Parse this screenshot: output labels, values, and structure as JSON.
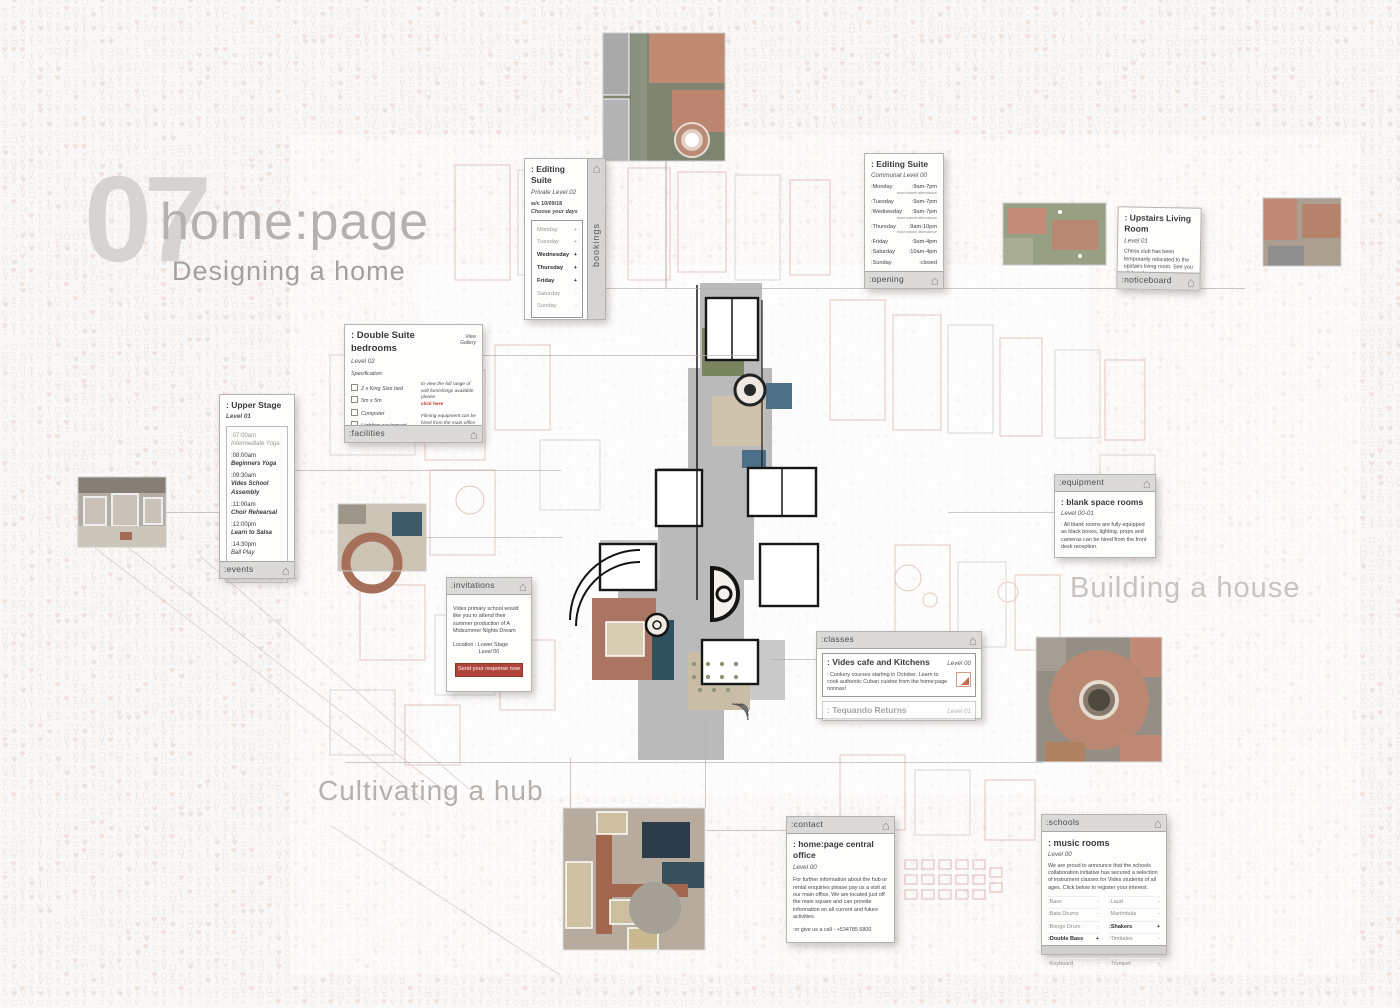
{
  "page": {
    "chapter_number": "07",
    "title": "home:page",
    "subtitle": "Designing a home",
    "section_building": "Building a house",
    "section_hub": "Cultivating a hub"
  },
  "colors": {
    "accent_red": "#b0463b",
    "link_red": "#c13a2b",
    "card_header_grey": "#dbdad8",
    "plan_brick": "#aa7663",
    "plan_blue": "#4d7088",
    "plan_green": "#78855f"
  },
  "icons": {
    "home": "⌂"
  },
  "cards": {
    "bookings": {
      "tab": "bookings",
      "title": ": Editing Suite",
      "level": "Private Level 02",
      "week": "w/c 10/09/18",
      "prompt": "Choose your days",
      "days": [
        {
          "label": "Monday",
          "mark": "+"
        },
        {
          "label": "Tuesday",
          "mark": "+"
        },
        {
          "label": "Wednesday",
          "mark": "+"
        },
        {
          "label": "Thursday",
          "mark": "+"
        },
        {
          "label": "Friday",
          "mark": "+"
        },
        {
          "label": "Saturday",
          "mark": "-"
        },
        {
          "label": "Sunday",
          "mark": "-"
        }
      ]
    },
    "opening": {
      "tab": ":opening",
      "title": ": Editing Suite",
      "level": "Communal Level 00",
      "hours": [
        {
          "day": ":Monday",
          "time": ":9am-7pm",
          "note": "must submit attendance"
        },
        {
          "day": ":Tuesday",
          "time": ":9am-7pm",
          "note": ""
        },
        {
          "day": ":Wednesday",
          "time": ":9am-7pm",
          "note": "must submit attendance"
        },
        {
          "day": ":Thursday",
          "time": ":9am-10pm",
          "note": "must submit attendance"
        },
        {
          "day": ":Friday",
          "time": ":9am-4pm",
          "note": ""
        },
        {
          "day": ":Saturday",
          "time": ":10am-4pm",
          "note": ""
        },
        {
          "day": ":Sunday",
          "time": ":closed",
          "note": ""
        }
      ]
    },
    "noticeboard": {
      "tab": ":noticeboard",
      "title": ": Upstairs Living Room",
      "level": "Level 01",
      "body": "Chess club has been temporarily relocated to the upstairs living room. See you all there!"
    },
    "facilities": {
      "tab": ":facilities",
      "title": ": Double Suite bedrooms",
      "gallery_link": "View Gallery",
      "level": "Level 02",
      "spec_heading": "Specification:",
      "spec_items": [
        "2 x King Size bed",
        "5m x 5m",
        "Computer",
        "Lighting equipment",
        "Blackout Shutters"
      ],
      "side_text": "to view the full range of soft furnishings available please",
      "side_link": "click here",
      "side_text2": "Filming equipment can be hired from the main office"
    },
    "events": {
      "tab": ":events",
      "title": ": Upper Stage",
      "level": "Level 01",
      "schedule": [
        {
          "time": ":07:00am",
          "name": "Intermediate Yoga"
        },
        {
          "time": ":08:00am",
          "name": "Beginners Yoga"
        },
        {
          "time": ":09:30am",
          "name": "Vides School Assembly"
        },
        {
          "time": ":11:00am",
          "name": "Choir Rehearsal"
        },
        {
          "time": ":12:00pm",
          "name": "Learn to Salsa"
        },
        {
          "time": ":14:30pm",
          "name": "Ball Play"
        },
        {
          "time": ":17:00pm",
          "name": "Drama Club"
        }
      ]
    },
    "equipment": {
      "tab": ":equipment",
      "title": ": blank space rooms",
      "level": "Level 00-01",
      "body": ": All blank rooms are fully equipped as black boxes, lighting, props and cameras can be hired from the front desk reception."
    },
    "invitations": {
      "tab": ":invitations",
      "body": "Vides primary school would like you to attend their summer production of A Midsummer Nights Dream",
      "location": "Location : Lower Stage",
      "location_level": "Level 00",
      "button": "Send your response now"
    },
    "classes": {
      "tab": ":classes",
      "items": [
        {
          "title": ": Vides cafe and Kitchens",
          "level": "Level 00",
          "desc": ": Cookery courses starting in October. Learn to cook authentic Cuban cuisine from the home:page nonnas!"
        },
        {
          "title": ": Tequando Returns",
          "level": "Level 01",
          "desc": ""
        }
      ]
    },
    "contact": {
      "tab": ":contact",
      "title": ": home:page central office",
      "level": "Level 00",
      "body": "For further information about the hub or rental enquiries please pay us a visit at our main office. We are located just off the main square and can provide information on all current and future activities.",
      "phone": ":or give us a call - +534785 6800"
    },
    "schools": {
      "tab": ":schools",
      "title": ": music rooms",
      "level": "Level 00",
      "body": "We are proud to announce that the schools collaboration initiative has secured a selection of instrument classes for Vides students of all ages. Click below to register your interest.",
      "instruments": [
        {
          "left": ":Bass",
          "left_mark": "-",
          "right": ":Laud",
          "right_mark": "-"
        },
        {
          "left": ":Bata Drums",
          "left_mark": "-",
          "right": ":Marimbula",
          "right_mark": "-"
        },
        {
          "left": ":Bongo Drum",
          "left_mark": "-",
          "right": ":Shakers",
          "right_mark": "+"
        },
        {
          "left": ":Double Bass",
          "left_mark": "+",
          "right": ":Timbales",
          "right_mark": "-"
        },
        {
          "left": ":Flute",
          "left_mark": "-",
          "right": ":Tres Cubano",
          "right_mark": "-"
        },
        {
          "left": ":Keyboard",
          "left_mark": "-",
          "right": ":Trumpet",
          "right_mark": "-"
        }
      ]
    }
  }
}
